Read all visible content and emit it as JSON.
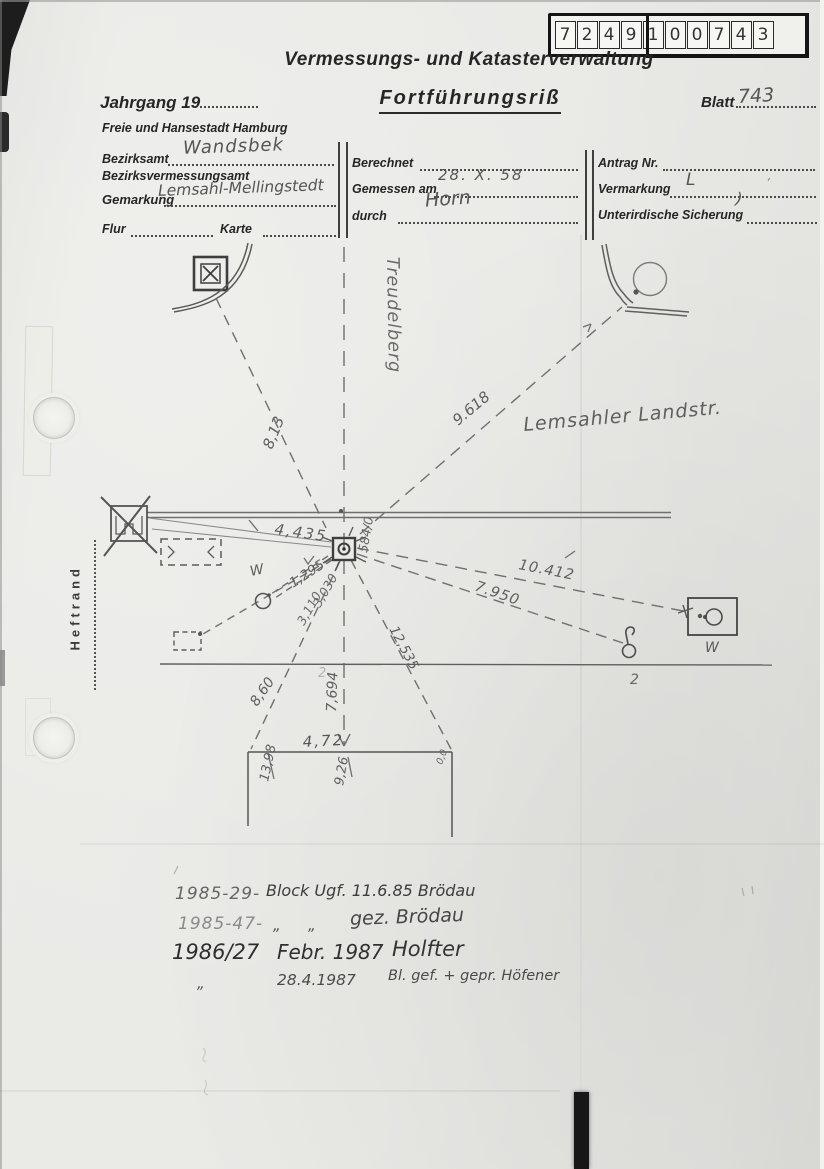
{
  "doc_number": {
    "digits": [
      "7",
      "2",
      "4",
      "9",
      "1",
      "0",
      "0",
      "7",
      "4",
      "3"
    ]
  },
  "header": {
    "agency": "Vermessungs- und Katasterverwaltung",
    "jahrgang_label": "Jahrgang 19",
    "title": "Fortführungsriß",
    "blatt_label": "Blatt",
    "blatt_value": "743",
    "city": "Freie und Hansestadt Hamburg"
  },
  "fields": {
    "bezirksamt_label": "Bezirksamt",
    "bezirksamt_value": "Wandsbek",
    "bva_label": "Bezirksvermessungsamt",
    "gemarkung_label": "Gemarkung",
    "gemarkung_value": "Lemsahl-Mellingstedt",
    "flur_label": "Flur",
    "karte_label": "Karte",
    "berechnet_label": "Berechnet",
    "gemessen_label": "Gemessen am",
    "gemessen_value": "28. X. 58",
    "durch_label": "durch",
    "durch_value": "Horn",
    "antrag_label": "Antrag Nr.",
    "vermarkung_label": "Vermarkung",
    "vermarkung_value": "L",
    "vermarkung_mark": "’",
    "sicherung_label": "Unterirdische Sicherung",
    "sicherung_value": ")"
  },
  "margin": {
    "heftrand": "Heftrand"
  },
  "sketch": {
    "street_vertical": "Treudelberg",
    "street_horizontal": "Lemsahler Landstr.",
    "point_label": "584/0",
    "w_left": "W",
    "w_right": "W",
    "point_2": "2",
    "faint_2": "2",
    "measurements": {
      "nw": "8,13",
      "ne": "9.618",
      "west": "4,435",
      "sw1": "1,295",
      "sw2": "3,030",
      "sw3": "3,110",
      "e1": "10.412",
      "e2": "7.950",
      "se": "12,535",
      "s1": "8,60",
      "s2": "7,694",
      "b_top": "4,72",
      "b_left": "13,98",
      "b_mid": "9,26",
      "b_right": "0,0"
    }
  },
  "notes": {
    "row1_ref": "1985-29-",
    "row1_text": "Block Ugf. 11.6.85 Brödau",
    "row2_ref": "1985-47-",
    "row2_ditto": "„",
    "row2_text": "gez. Brödau",
    "row3_ref": "1986/27",
    "row3_date": "Febr. 1987",
    "row3_name": "Holfter",
    "row4_ditto": "„",
    "row4_date": "28.4.1987",
    "row4_text": "Bl. gef. + gepr. Höfener"
  }
}
